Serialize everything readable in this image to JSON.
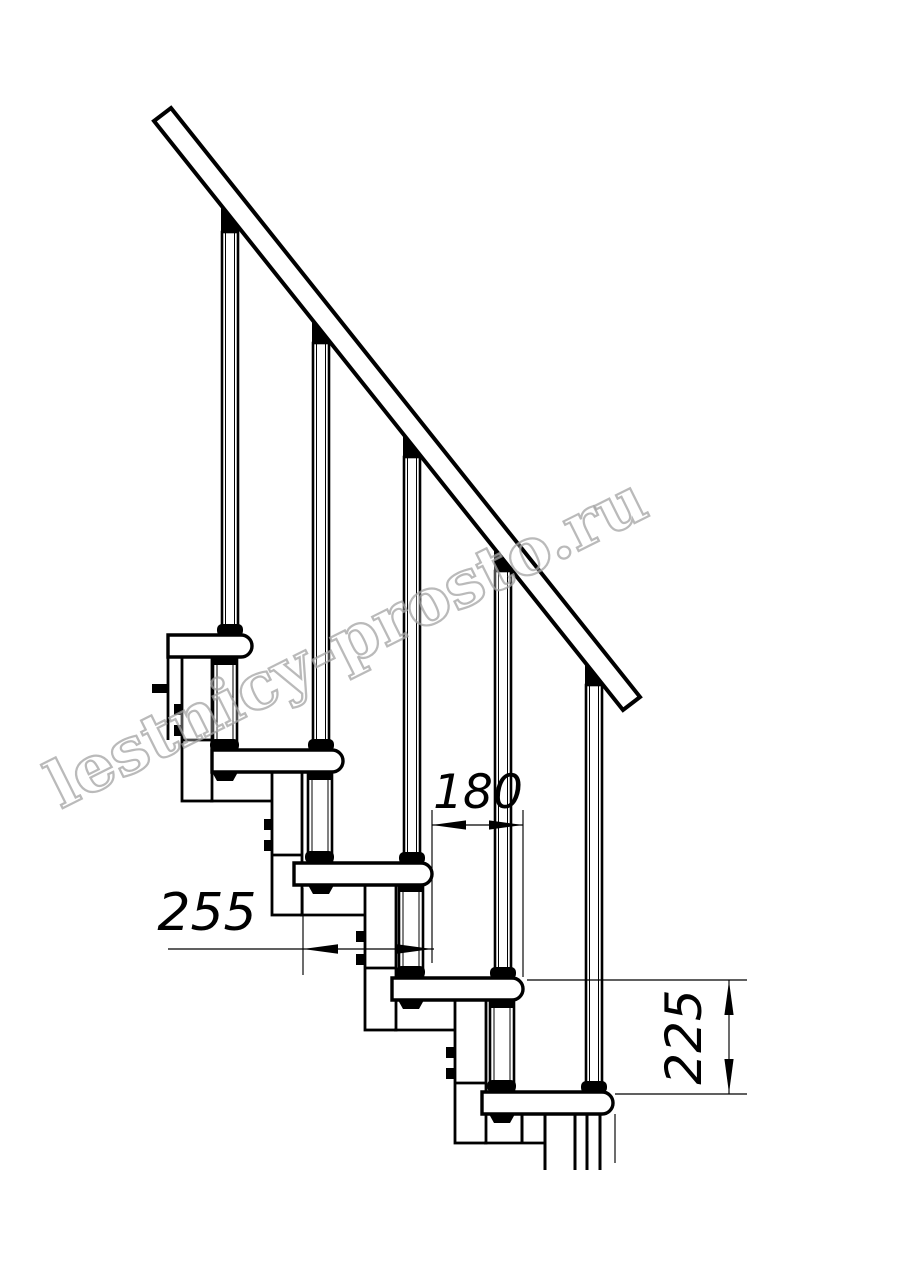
{
  "page": {
    "background": "#ffffff"
  },
  "colors": {
    "line": "#000000",
    "watermark_outline": "#a3a3a3"
  },
  "watermark": {
    "text": "lestnicy-prosto.ru"
  },
  "dimensions": {
    "step_run": {
      "value": "180"
    },
    "tread_depth": {
      "value": "255"
    },
    "step_rise": {
      "value": "225"
    }
  },
  "structure": {
    "treads": 5,
    "balusters": 5,
    "support_modules": 4
  }
}
